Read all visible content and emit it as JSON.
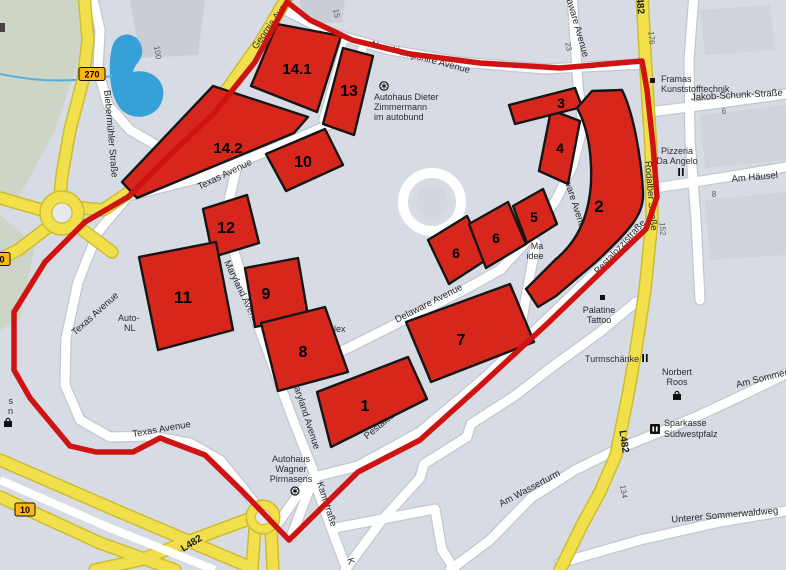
{
  "map": {
    "title": "Pirmasens industrial area zone map",
    "zones": [
      {
        "label": "14.1"
      },
      {
        "label": "13"
      },
      {
        "label": "14.2"
      },
      {
        "label": "10"
      },
      {
        "label": "12"
      },
      {
        "label": "11"
      },
      {
        "label": "9"
      },
      {
        "label": "8"
      },
      {
        "label": "1"
      },
      {
        "label": "7"
      },
      {
        "label": "6"
      },
      {
        "label": "6"
      },
      {
        "label": "5"
      },
      {
        "label": "4"
      },
      {
        "label": "3"
      },
      {
        "label": "2"
      }
    ],
    "streets": {
      "georgia": "Georgia Avenue",
      "new_hampshire": "New Hampshire Avenue",
      "texas": "Texas Avenue",
      "maryland": "Maryland Avenue",
      "delaware": "Delaware Avenue",
      "pestalozzi": "Pestalozzistraße",
      "rodalber": "Rodalber Straße",
      "biebermuehler": "Biebermühler Straße",
      "jakob_schunk": "Jakob-Schunk-Straße",
      "am_haeusel": "Am Häusel",
      "am_wasserturm": "Am Wasserturm",
      "am_sommerwald": "Am Sommerwald",
      "unterer_sommerwaldweg": "Unterer Sommerwaldweg",
      "kantstrasse": "Kantstraße",
      "k_fragment": "K"
    },
    "road_refs": {
      "l482": "L482",
      "b270": "270",
      "b10": "10"
    },
    "house_numbers": {
      "h100": "100",
      "h15": "15",
      "h23": "23",
      "h176": "176",
      "h152": "152",
      "h134": "134",
      "h6": "6",
      "h8": "8"
    },
    "pois": {
      "autohaus_dieter": {
        "line1": "Autohaus Dieter",
        "line2": "Zimmermann",
        "line3": "im autobund"
      },
      "framas": {
        "line1": "Framas",
        "line2": "Kunststofftechnik"
      },
      "pizzeria": {
        "line1": "Pizzeria",
        "line2": "Da Angelo"
      },
      "palatine": {
        "line1": "Palatine",
        "line2": "Tattoo"
      },
      "turmschaenke": {
        "line1": "Turmschänke"
      },
      "norbert_roos": {
        "line1": "Norbert",
        "line2": "Roos"
      },
      "sparkasse": {
        "line1": "Sparkasse",
        "line2": "Südwestpfalz"
      },
      "autohaus_wagner": {
        "line1": "Autohaus",
        "line2": "Wagner",
        "line3": "Pirmasens"
      },
      "auto_fragment": {
        "line1": "Auto-",
        "line2": "NL"
      },
      "ma_fragment": {
        "line1": "Ma",
        "line2": "idee"
      },
      "lex_fragment": {
        "line1": "lex"
      },
      "edge_fragment": {
        "line1": "s",
        "line2": "n"
      }
    },
    "colors": {
      "background": "#d7dbe3",
      "zone_red": "#d7271c",
      "boundary_red": "#ce1312",
      "road_yellow": "#f1df4b",
      "badge_orange": "#ffb612",
      "water_blue": "#36a0d8",
      "green_area": "#ccd5c6"
    }
  }
}
